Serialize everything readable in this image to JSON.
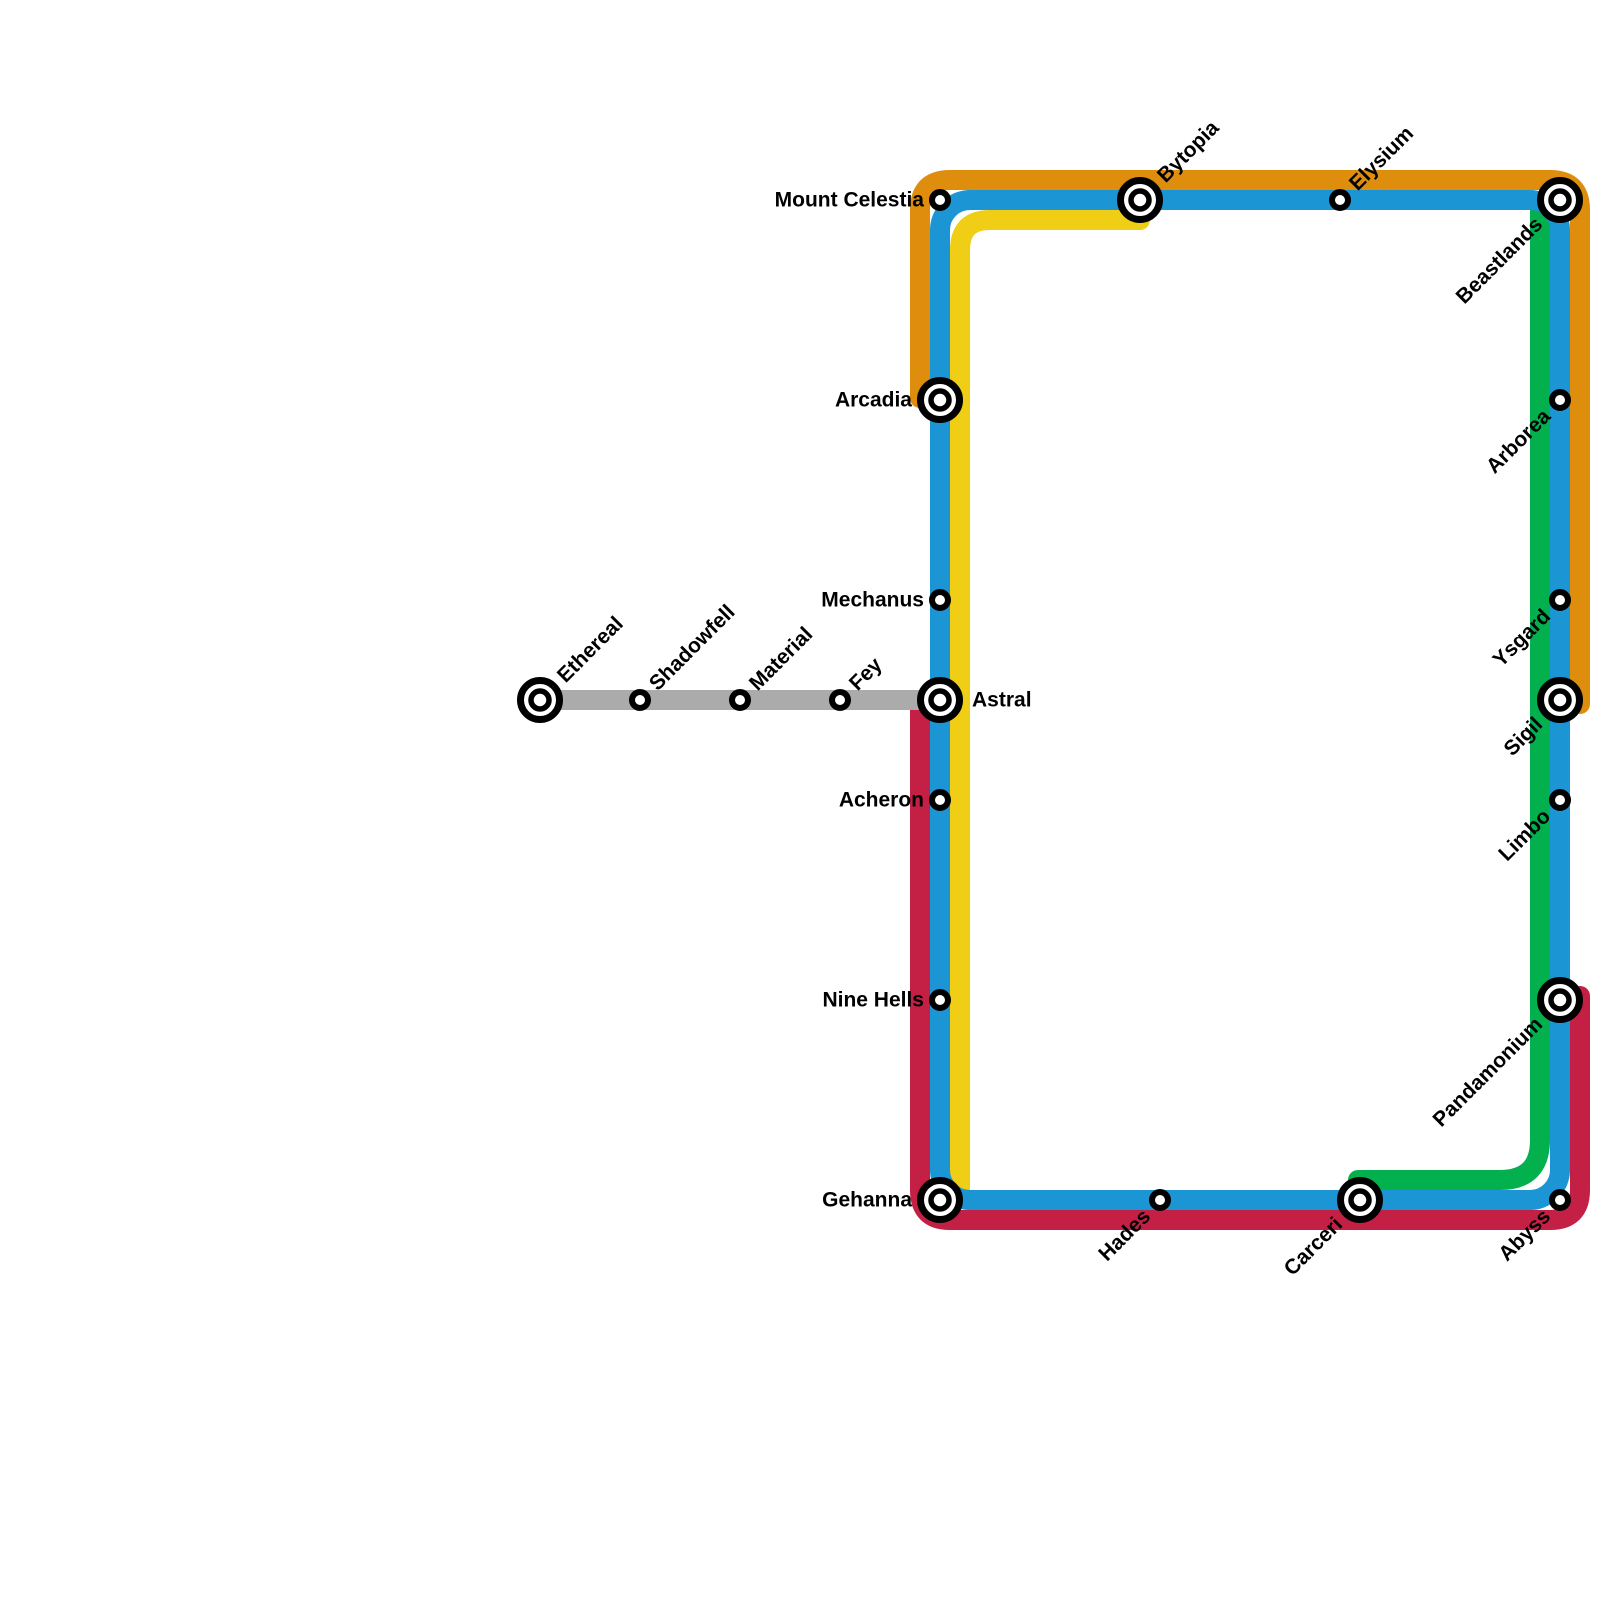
{
  "canvas": {
    "width": 1600,
    "height": 1600,
    "background": "#ffffff"
  },
  "map": {
    "line_thickness": 20,
    "corner_radius": 30,
    "label_font_size": 21,
    "station_style": {
      "small_outer_radius": 11,
      "large_outer_radius": 23,
      "ring_color": "#000000",
      "fill_color": "#ffffff"
    },
    "lines": [
      {
        "id": "yellow",
        "name": "yellow-line",
        "color": "#F0CE15",
        "radius": 30,
        "points": [
          [
            1140,
            220
          ],
          [
            960,
            220
          ],
          [
            960,
            1195
          ]
        ]
      },
      {
        "id": "red",
        "name": "red-line",
        "color": "#C42045",
        "radius": 30,
        "points": [
          [
            920,
            706
          ],
          [
            920,
            1220
          ],
          [
            1580,
            1220
          ],
          [
            1580,
            996
          ]
        ]
      },
      {
        "id": "green",
        "name": "green-line",
        "color": "#02B04E",
        "radius": 40,
        "points": [
          [
            1540,
            212
          ],
          [
            1540,
            1180
          ],
          [
            1358,
            1180
          ]
        ]
      },
      {
        "id": "orange",
        "name": "orange-line",
        "color": "#DE8D0C",
        "radius": 30,
        "points": [
          [
            920,
            398
          ],
          [
            920,
            180
          ],
          [
            1580,
            180
          ],
          [
            1580,
            704
          ]
        ]
      },
      {
        "id": "gray",
        "name": "gray-line",
        "color": "#ABABAB",
        "radius": 30,
        "points": [
          [
            540,
            700
          ],
          [
            940,
            700
          ]
        ]
      },
      {
        "id": "blue",
        "name": "blue-loop-line",
        "color": "#1B95D4",
        "shape": "closed-rect",
        "rect": {
          "x": 940,
          "y": 200,
          "width": 620,
          "height": 1000,
          "rx": 30
        }
      }
    ],
    "stations": [
      {
        "name": "Mount Celestia",
        "x": 940,
        "y": 200,
        "type": "small",
        "label": "left"
      },
      {
        "name": "Bytopia",
        "x": 1140,
        "y": 200,
        "type": "large",
        "label": "up-right"
      },
      {
        "name": "Elysium",
        "x": 1340,
        "y": 200,
        "type": "small",
        "label": "up-right"
      },
      {
        "name": "Beastlands",
        "x": 1560,
        "y": 200,
        "type": "large",
        "label": "down-left"
      },
      {
        "name": "Arcadia",
        "x": 940,
        "y": 400,
        "type": "large",
        "label": "left"
      },
      {
        "name": "Arborea",
        "x": 1560,
        "y": 400,
        "type": "small",
        "label": "down-left"
      },
      {
        "name": "Mechanus",
        "x": 940,
        "y": 600,
        "type": "small",
        "label": "left"
      },
      {
        "name": "Ysgard",
        "x": 1560,
        "y": 600,
        "type": "small",
        "label": "down-left"
      },
      {
        "name": "Ethereal",
        "x": 540,
        "y": 700,
        "type": "large",
        "label": "up-right"
      },
      {
        "name": "Shadowfell",
        "x": 640,
        "y": 700,
        "type": "small",
        "label": "up-right"
      },
      {
        "name": "Material",
        "x": 740,
        "y": 700,
        "type": "small",
        "label": "up-right"
      },
      {
        "name": "Fey",
        "x": 840,
        "y": 700,
        "type": "small",
        "label": "up-right"
      },
      {
        "name": "Astral",
        "x": 940,
        "y": 700,
        "type": "large",
        "label": "right"
      },
      {
        "name": "Sigil",
        "x": 1560,
        "y": 700,
        "type": "large",
        "label": "down-left"
      },
      {
        "name": "Acheron",
        "x": 940,
        "y": 800,
        "type": "small",
        "label": "left"
      },
      {
        "name": "Limbo",
        "x": 1560,
        "y": 800,
        "type": "small",
        "label": "down-left"
      },
      {
        "name": "Nine Hells",
        "x": 940,
        "y": 1000,
        "type": "small",
        "label": "left"
      },
      {
        "name": "Pandamonium",
        "x": 1560,
        "y": 1000,
        "type": "large",
        "label": "down-left"
      },
      {
        "name": "Gehanna",
        "x": 940,
        "y": 1200,
        "type": "large",
        "label": "left"
      },
      {
        "name": "Hades",
        "x": 1160,
        "y": 1200,
        "type": "small",
        "label": "down-left"
      },
      {
        "name": "Carceri",
        "x": 1360,
        "y": 1200,
        "type": "large",
        "label": "down-left"
      },
      {
        "name": "Abyss",
        "x": 1560,
        "y": 1200,
        "type": "small",
        "label": "down-left"
      }
    ]
  }
}
